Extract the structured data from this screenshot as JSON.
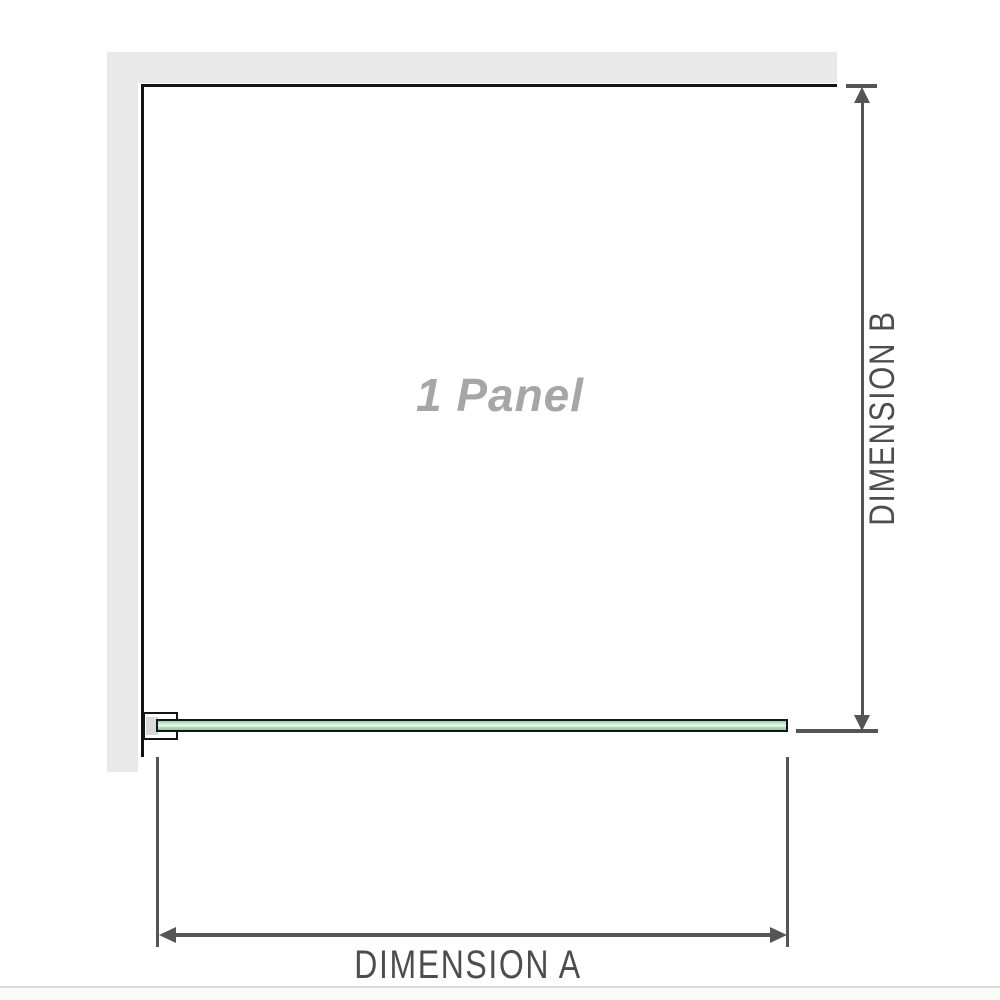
{
  "diagram": {
    "panel_label": "1 Panel",
    "dimension_a": {
      "label": "DIMENSION A",
      "axis": "horizontal"
    },
    "dimension_b": {
      "label": "DIMENSION B",
      "axis": "vertical"
    }
  },
  "icons": {
    "dimension_b_top": "arrow-up-icon",
    "dimension_b_bottom": "arrow-down-icon",
    "dimension_a_left": "arrow-left-icon",
    "dimension_a_right": "arrow-right-icon"
  },
  "colors": {
    "wall_gray": "#e9e9e9",
    "outline_black": "#141414",
    "dimension_line_gray": "#555555",
    "dimension_text_gray": "#4d4d4d",
    "watermark_gray": "#a6a6a6",
    "glass_green": "#98cfa8",
    "glass_green_highlight": "#f1f8f2",
    "bracket_shim_gray": "#d9d9d9",
    "separator_gray": "#dbdad6"
  }
}
